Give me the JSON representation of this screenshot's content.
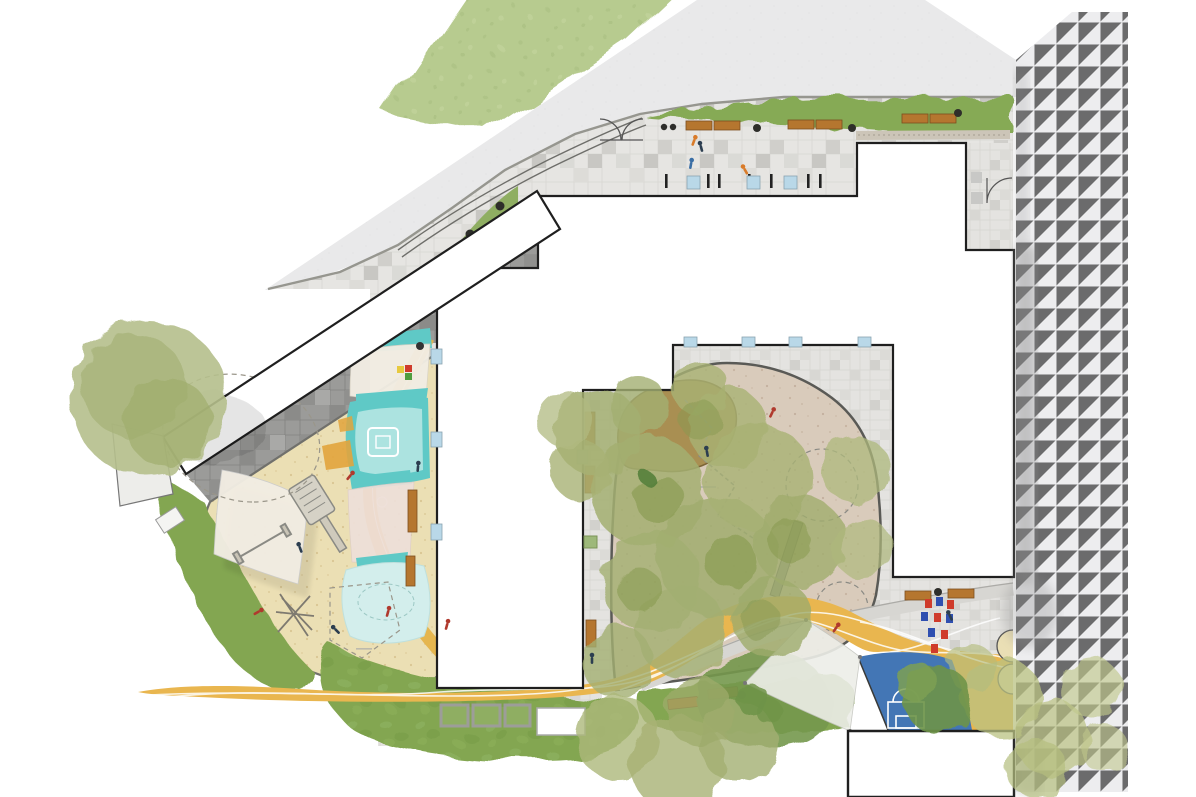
{
  "plan": {
    "kind": "landscape-site-plan",
    "text_visible": "none (graphic drawing only, equipment labels illegible at this scale)"
  },
  "colors": {
    "background": "#ffffff",
    "road": "#e9e9ea",
    "road_side": "#ededef",
    "lawn": "#b7cb8f",
    "hedge": "#86aa55",
    "grass": "#83a651",
    "grass_dark": "#6f9348",
    "planting": "#8fae62",
    "paver_light": "#e6e5e2",
    "paver_dark": "#9b9b99",
    "building": "#ffffff",
    "wall": "#1f1f1f",
    "sand": "#ebdfb4",
    "sand_edge": "#70706c",
    "teal": "#5fc9c6",
    "teal_light": "#ace3e0",
    "teal_pale": "#d3eeec",
    "sail": "#f2ede3",
    "sail_pink": "#eedfd9",
    "sail_gray": "#edeee8",
    "path_yellow": "#e9b64f",
    "forest_ground": "#d9cbbb",
    "mound": "#a98f52",
    "tree": "#a3af72",
    "tree_dark": "#87994f",
    "court_blue": "#4376b5",
    "bench": "#b5762f",
    "window": "#b9d8e8",
    "window_gray": "#c8c8c6",
    "tile_red": "#cf3b2b",
    "tile_blue": "#2f4fb0",
    "tile_yellow": "#e7c93f",
    "tile_green": "#4f9e3f",
    "people_red": "#b03a2e",
    "people_navy": "#2c3e50",
    "people_orange": "#d97b29"
  },
  "legend": [
    {
      "name": "access-road",
      "color_key": "road"
    },
    {
      "name": "side-road",
      "color_key": "road_side"
    },
    {
      "name": "upper-lawn",
      "color_key": "lawn"
    },
    {
      "name": "entry-plaza-pavers",
      "color_key": "paver_light"
    },
    {
      "name": "hedge-strip-with-benches",
      "color_key": "hedge"
    },
    {
      "name": "buildings",
      "color_key": "building"
    },
    {
      "name": "sand-playground",
      "color_key": "sand"
    },
    {
      "name": "shade-sails",
      "color_key": "sail"
    },
    {
      "name": "water-play-teal",
      "color_key": "teal"
    },
    {
      "name": "running-path-yellow",
      "color_key": "path_yellow"
    },
    {
      "name": "forest-play-courtyard",
      "color_key": "forest_ground"
    },
    {
      "name": "play-mound",
      "color_key": "mound"
    },
    {
      "name": "ball-court",
      "color_key": "court_blue"
    },
    {
      "name": "lawn-wedges",
      "color_key": "grass"
    },
    {
      "name": "raised-planters",
      "color_key": "planting"
    },
    {
      "name": "wood-benches",
      "color_key": "bench"
    }
  ],
  "counts": {
    "hedge_benches": 6,
    "raised_planters": 3,
    "shade_sails": 4,
    "ball_goals": 1
  }
}
